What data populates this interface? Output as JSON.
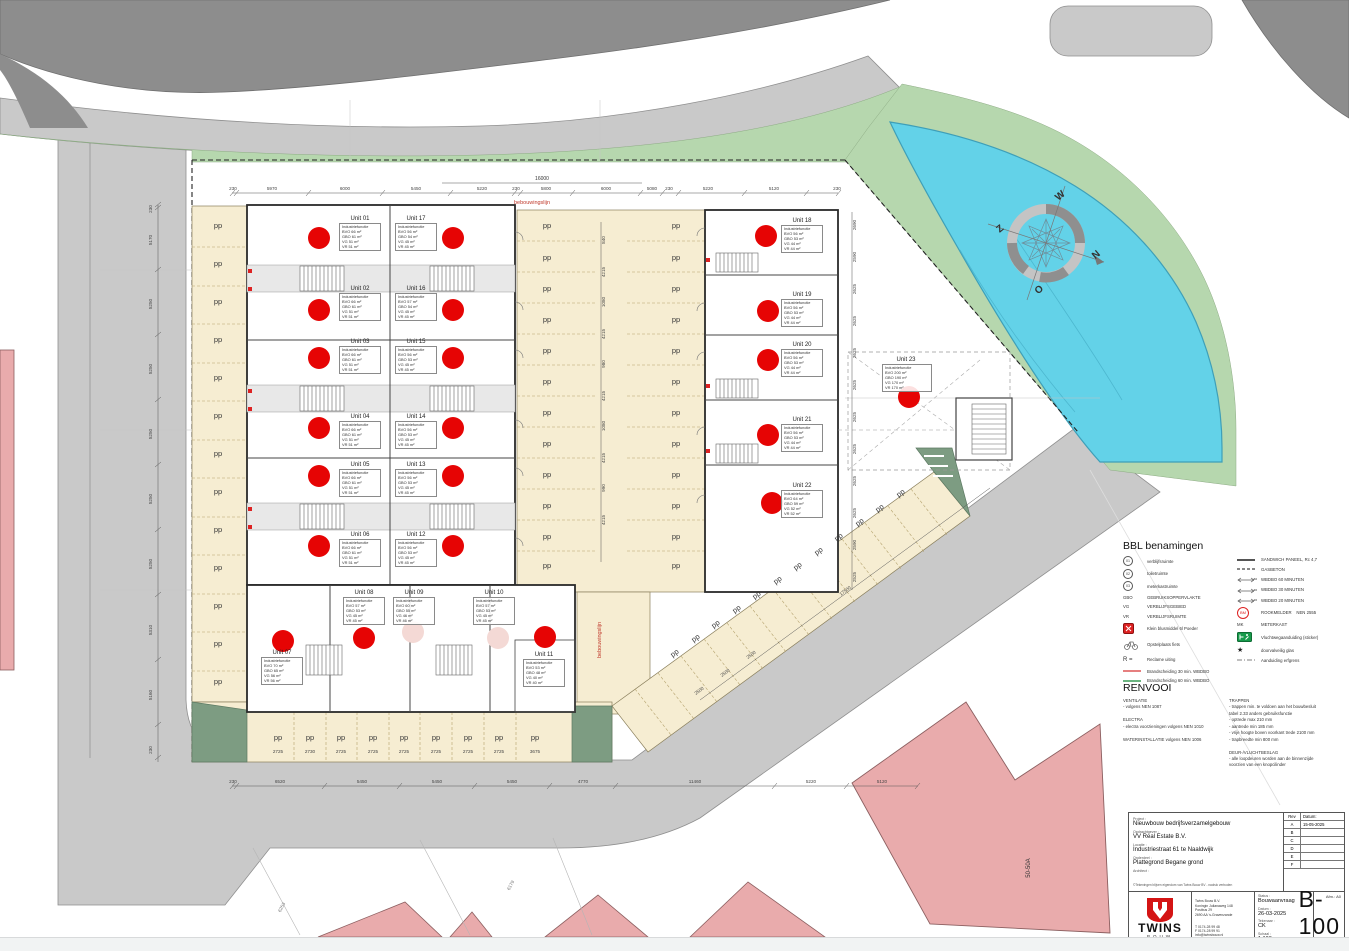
{
  "parking": {
    "label": "pp"
  },
  "compass": {
    "n": "N",
    "o": "O",
    "z": "Z",
    "w": "W"
  },
  "annotations": {
    "build_line": "bebouwingslijn",
    "parcel_building": "50-50A",
    "parcel_a": "6253",
    "parcel_b": "6179"
  },
  "dims": {
    "top": [
      "230",
      "5970",
      "6000",
      "5450",
      "5220",
      "230",
      "5800",
      "6000",
      "5080",
      "230",
      "5220",
      "5120",
      "230"
    ],
    "top_overall": "16000",
    "bottom": [
      "230",
      "6520",
      "5450",
      "5450",
      "5450",
      "4770",
      "11460",
      "5220",
      "5120"
    ],
    "left": [
      "230",
      "5170",
      "5250",
      "5250",
      "5250",
      "5250",
      "5250",
      "5310",
      "5160",
      "230"
    ],
    "right": [
      "2690",
      "2590",
      "2625",
      "2625",
      "2625",
      "2625",
      "2625",
      "2625",
      "2625",
      "2625",
      "2590",
      "2525"
    ],
    "lane": [
      "840",
      "4215",
      "1080",
      "4215",
      "980",
      "4215",
      "1080",
      "4215",
      "990",
      "4215"
    ],
    "bottom_slots": [
      "2725",
      "2730",
      "2725",
      "2725",
      "2725",
      "2725",
      "2725",
      "2725",
      "3675"
    ],
    "diag_road": "17500",
    "diag_slots": [
      "2500",
      "2500",
      "2500"
    ]
  },
  "units": {
    "u01": {
      "name": "Unit 01",
      "table": "Industriefunctie\nBVO 66 m²\nGBO 61 m²\nVG 51 m²\nVR 51 m²"
    },
    "u02": {
      "name": "Unit 02",
      "table": "Industriefunctie\nBVO 66 m²\nGBO 61 m²\nVG 51 m²\nVR 51 m²"
    },
    "u03": {
      "name": "Unit 03",
      "table": "Industriefunctie\nBVO 66 m²\nGBO 61 m²\nVG 51 m²\nVR 51 m²"
    },
    "u04": {
      "name": "Unit 04",
      "table": "Industriefunctie\nBVO 66 m²\nGBO 61 m²\nVG 51 m²\nVR 51 m²"
    },
    "u05": {
      "name": "Unit 05",
      "table": "Industriefunctie\nBVO 66 m²\nGBO 61 m²\nVG 51 m²\nVR 51 m²"
    },
    "u06": {
      "name": "Unit 06",
      "table": "Industriefunctie\nBVO 66 m²\nGBO 61 m²\nVG 51 m²\nVR 51 m²"
    },
    "u07": {
      "name": "Unit 07",
      "table": "Industriefunctie\nBVO 70 m²\nGBO 65 m²\nVG 56 m²\nVR 56 m²"
    },
    "u08": {
      "name": "Unit 08",
      "table": "Industriefunctie\nBVO 57 m²\nGBO 53 m²\nVG 45 m²\nVR 45 m²"
    },
    "u09": {
      "name": "Unit 09",
      "table": "Industriefunctie\nBVO 60 m²\nGBO 55 m²\nVG 46 m²\nVR 46 m²"
    },
    "u10": {
      "name": "Unit 10",
      "table": "Industriefunctie\nBVO 57 m²\nGBO 53 m²\nVG 45 m²\nVR 45 m²"
    },
    "u11": {
      "name": "Unit 11",
      "table": "Industriefunctie\nBVO 53 m²\nGBO 48 m²\nVG 40 m²\nVR 40 m²"
    },
    "u12": {
      "name": "Unit 12",
      "table": "Industriefunctie\nBVO 56 m²\nGBO 53 m²\nVG 45 m²\nVR 45 m²"
    },
    "u13": {
      "name": "Unit 13",
      "table": "Industriefunctie\nBVO 56 m²\nGBO 53 m²\nVG 45 m²\nVR 45 m²"
    },
    "u14": {
      "name": "Unit 14",
      "table": "Industriefunctie\nBVO 56 m²\nGBO 53 m²\nVG 45 m²\nVR 45 m²"
    },
    "u15": {
      "name": "Unit 15",
      "table": "Industriefunctie\nBVO 56 m²\nGBO 53 m²\nVG 45 m²\nVR 45 m²"
    },
    "u16": {
      "name": "Unit 16",
      "table": "Industriefunctie\nBVO 57 m²\nGBO 54 m²\nVG 45 m²\nVR 45 m²"
    },
    "u17": {
      "name": "Unit 17",
      "table": "Industriefunctie\nBVO 56 m²\nGBO 54 m²\nVG 45 m²\nVR 45 m²"
    },
    "u18": {
      "name": "Unit 18",
      "table": "Industriefunctie\nBVO 56 m²\nGBO 53 m²\nVG 44 m²\nVR 44 m²"
    },
    "u19": {
      "name": "Unit 19",
      "table": "Industriefunctie\nBVO 56 m²\nGBO 53 m²\nVG 44 m²\nVR 44 m²"
    },
    "u20": {
      "name": "Unit 20",
      "table": "Industriefunctie\nBVO 56 m²\nGBO 53 m²\nVG 44 m²\nVR 44 m²"
    },
    "u21": {
      "name": "Unit 21",
      "table": "Industriefunctie\nBVO 56 m²\nGBO 53 m²\nVG 44 m²\nVR 44 m²"
    },
    "u22": {
      "name": "Unit 22",
      "table": "Industriefunctie\nBVO 64 m²\nGBO 59 m²\nVG 52 m²\nVR 52 m²"
    },
    "u23": {
      "name": "Unit 23",
      "table": "Industriefunctie\nBVO 200 m²\nGBO 190 m²\nVG 170 m²\nVR 170 m²"
    }
  },
  "legend": {
    "title": "BBL benamingen",
    "left": [
      {
        "icon": "circle-number",
        "glyph": "01",
        "label": "verblijfsruimte"
      },
      {
        "icon": "circle-number",
        "glyph": "02",
        "label": "toiletruimte"
      },
      {
        "icon": "circle-number",
        "glyph": "03",
        "label": "meterkastruimte"
      },
      {
        "icon": "abbr",
        "glyph": "GBO",
        "label": "GEBRUIKSOPPERVLAKTE"
      },
      {
        "icon": "abbr",
        "glyph": "VG",
        "label": "VERBLIJFSGEBIED"
      },
      {
        "icon": "abbr",
        "glyph": "VR",
        "label": "VERBLIJFSRUIMTE"
      },
      {
        "icon": "fire-extinguisher",
        "glyph": "",
        "label": "Klein blusmiddel 6l Poeder"
      },
      {
        "icon": "bicycle",
        "glyph": "",
        "label": "Opstelplaats fiets"
      },
      {
        "icon": "abbr",
        "glyph": "R =",
        "label": "Reclame uiting"
      },
      {
        "icon": "line-red",
        "glyph": "",
        "label": "Brandscheiding 30 min. WBDBO"
      },
      {
        "icon": "line-green",
        "glyph": "",
        "label": "Brandscheiding 60 min. WBDBO"
      }
    ],
    "right": [
      {
        "icon": "line-solid",
        "glyph": "",
        "label": "SANDWICH PANEEL, Rc 4,7"
      },
      {
        "icon": "line-dashed",
        "glyph": "",
        "label": "GASBETON"
      },
      {
        "icon": "arrow-line",
        "glyph": "60",
        "label": "WBDBO 60 MINUTEN"
      },
      {
        "icon": "arrow-line",
        "glyph": "30",
        "label": "WBDBO 30 MINUTEN"
      },
      {
        "icon": "arrow-line",
        "glyph": "20",
        "label": "WBDBO 20 MINUTEN"
      },
      {
        "icon": "smoke-detector",
        "glyph": "BM",
        "label": "ROOKMELDER    NEN 2555"
      },
      {
        "icon": "abbr",
        "glyph": "MK",
        "label": "METERKAST"
      },
      {
        "icon": "exit-sign",
        "glyph": "",
        "label": "Vluchtwegaanduiding (sticker)"
      },
      {
        "icon": "star",
        "glyph": "★",
        "label": "doorvalveilig glas"
      },
      {
        "icon": "line-boundary",
        "glyph": "",
        "label": "Aanduiding erfgrens"
      }
    ]
  },
  "renvooi": {
    "title": "RENVOOI",
    "col1": "VENTILATIE\n- volgens NEN 1087\n\nELECTRA\n- electra voorzieningen volgens NEN 1010\n\nWATERINSTALLATIE volgens NEN 1006",
    "col2": "TRAPPEN\n- trappen min. te voldoen aan het bouwbesluit\n  tabel 2.33 anders gebruiksfunctie\n- optrede max 210 mm\n- aantrede min 185 mm\n- vrije hoogte boven voorkant trede 2100 mm\n- trapbreedte min 800 mm\n\nDEUR-/VLUCHTBESLAG\n-  alle loopdeuren worden aan de binnenzijde\n   voorzien van een knopcilinder"
  },
  "titleblock": {
    "fields": [
      {
        "label": "Project :",
        "value": "Nieuwbouw bedrijfsverzamelgebouw"
      },
      {
        "label": "Opdrachtgever :",
        "value": "VV Real Estate B.V."
      },
      {
        "label": "Locatie :",
        "value": "Industriestraat 61 te Naaldwijk"
      },
      {
        "label": "Onderdeel :",
        "value": "Plattegrond Begane grond"
      },
      {
        "label": "Architect :",
        "value": ""
      }
    ],
    "copyright": "©Tekeningen blijven eigendom van Twins Bouw BV - nadruk verboden",
    "rev_header": {
      "rev": "Rev",
      "date": "Datum:"
    },
    "revisions": [
      {
        "rev": "A",
        "date": "15-05-2025"
      },
      {
        "rev": "B",
        "date": ""
      },
      {
        "rev": "C",
        "date": ""
      },
      {
        "rev": "D",
        "date": ""
      },
      {
        "rev": "E",
        "date": ""
      },
      {
        "rev": "F",
        "date": ""
      }
    ],
    "company": {
      "name": "TWINS",
      "sub": "BOUW",
      "address": "Twins Bouw B.V.\nKoningin Julianaweg 148\nPostbus 29\n2690 AA 's-Gravenzande",
      "contact": "T 0174-28 99 48\nF 0174-28 99 91\ninfo@twinsbouw.nl\nwww.twinsbouw.nl"
    },
    "meta": [
      {
        "label": "Status :",
        "value": "Bouwaanvraag"
      },
      {
        "label": "Datum :",
        "value": "26-03-2025"
      },
      {
        "label": "Tekenaar :",
        "value": "CK"
      },
      {
        "label": "Schaal :",
        "value": "1:100"
      },
      {
        "label": "Werk nr :",
        "value": ""
      }
    ],
    "size_label": "Afm.: A0",
    "number": "B-100"
  },
  "colors": {
    "accent_red": "#e60404",
    "water": "#63d2e8",
    "green": "#b6d7ae",
    "green_dark": "#7d9c82",
    "road_light": "#c9c9c9",
    "road_dark": "#8d8d8d",
    "parking_beige": "#f6edd2",
    "neighbor_pink": "#e9abac"
  }
}
